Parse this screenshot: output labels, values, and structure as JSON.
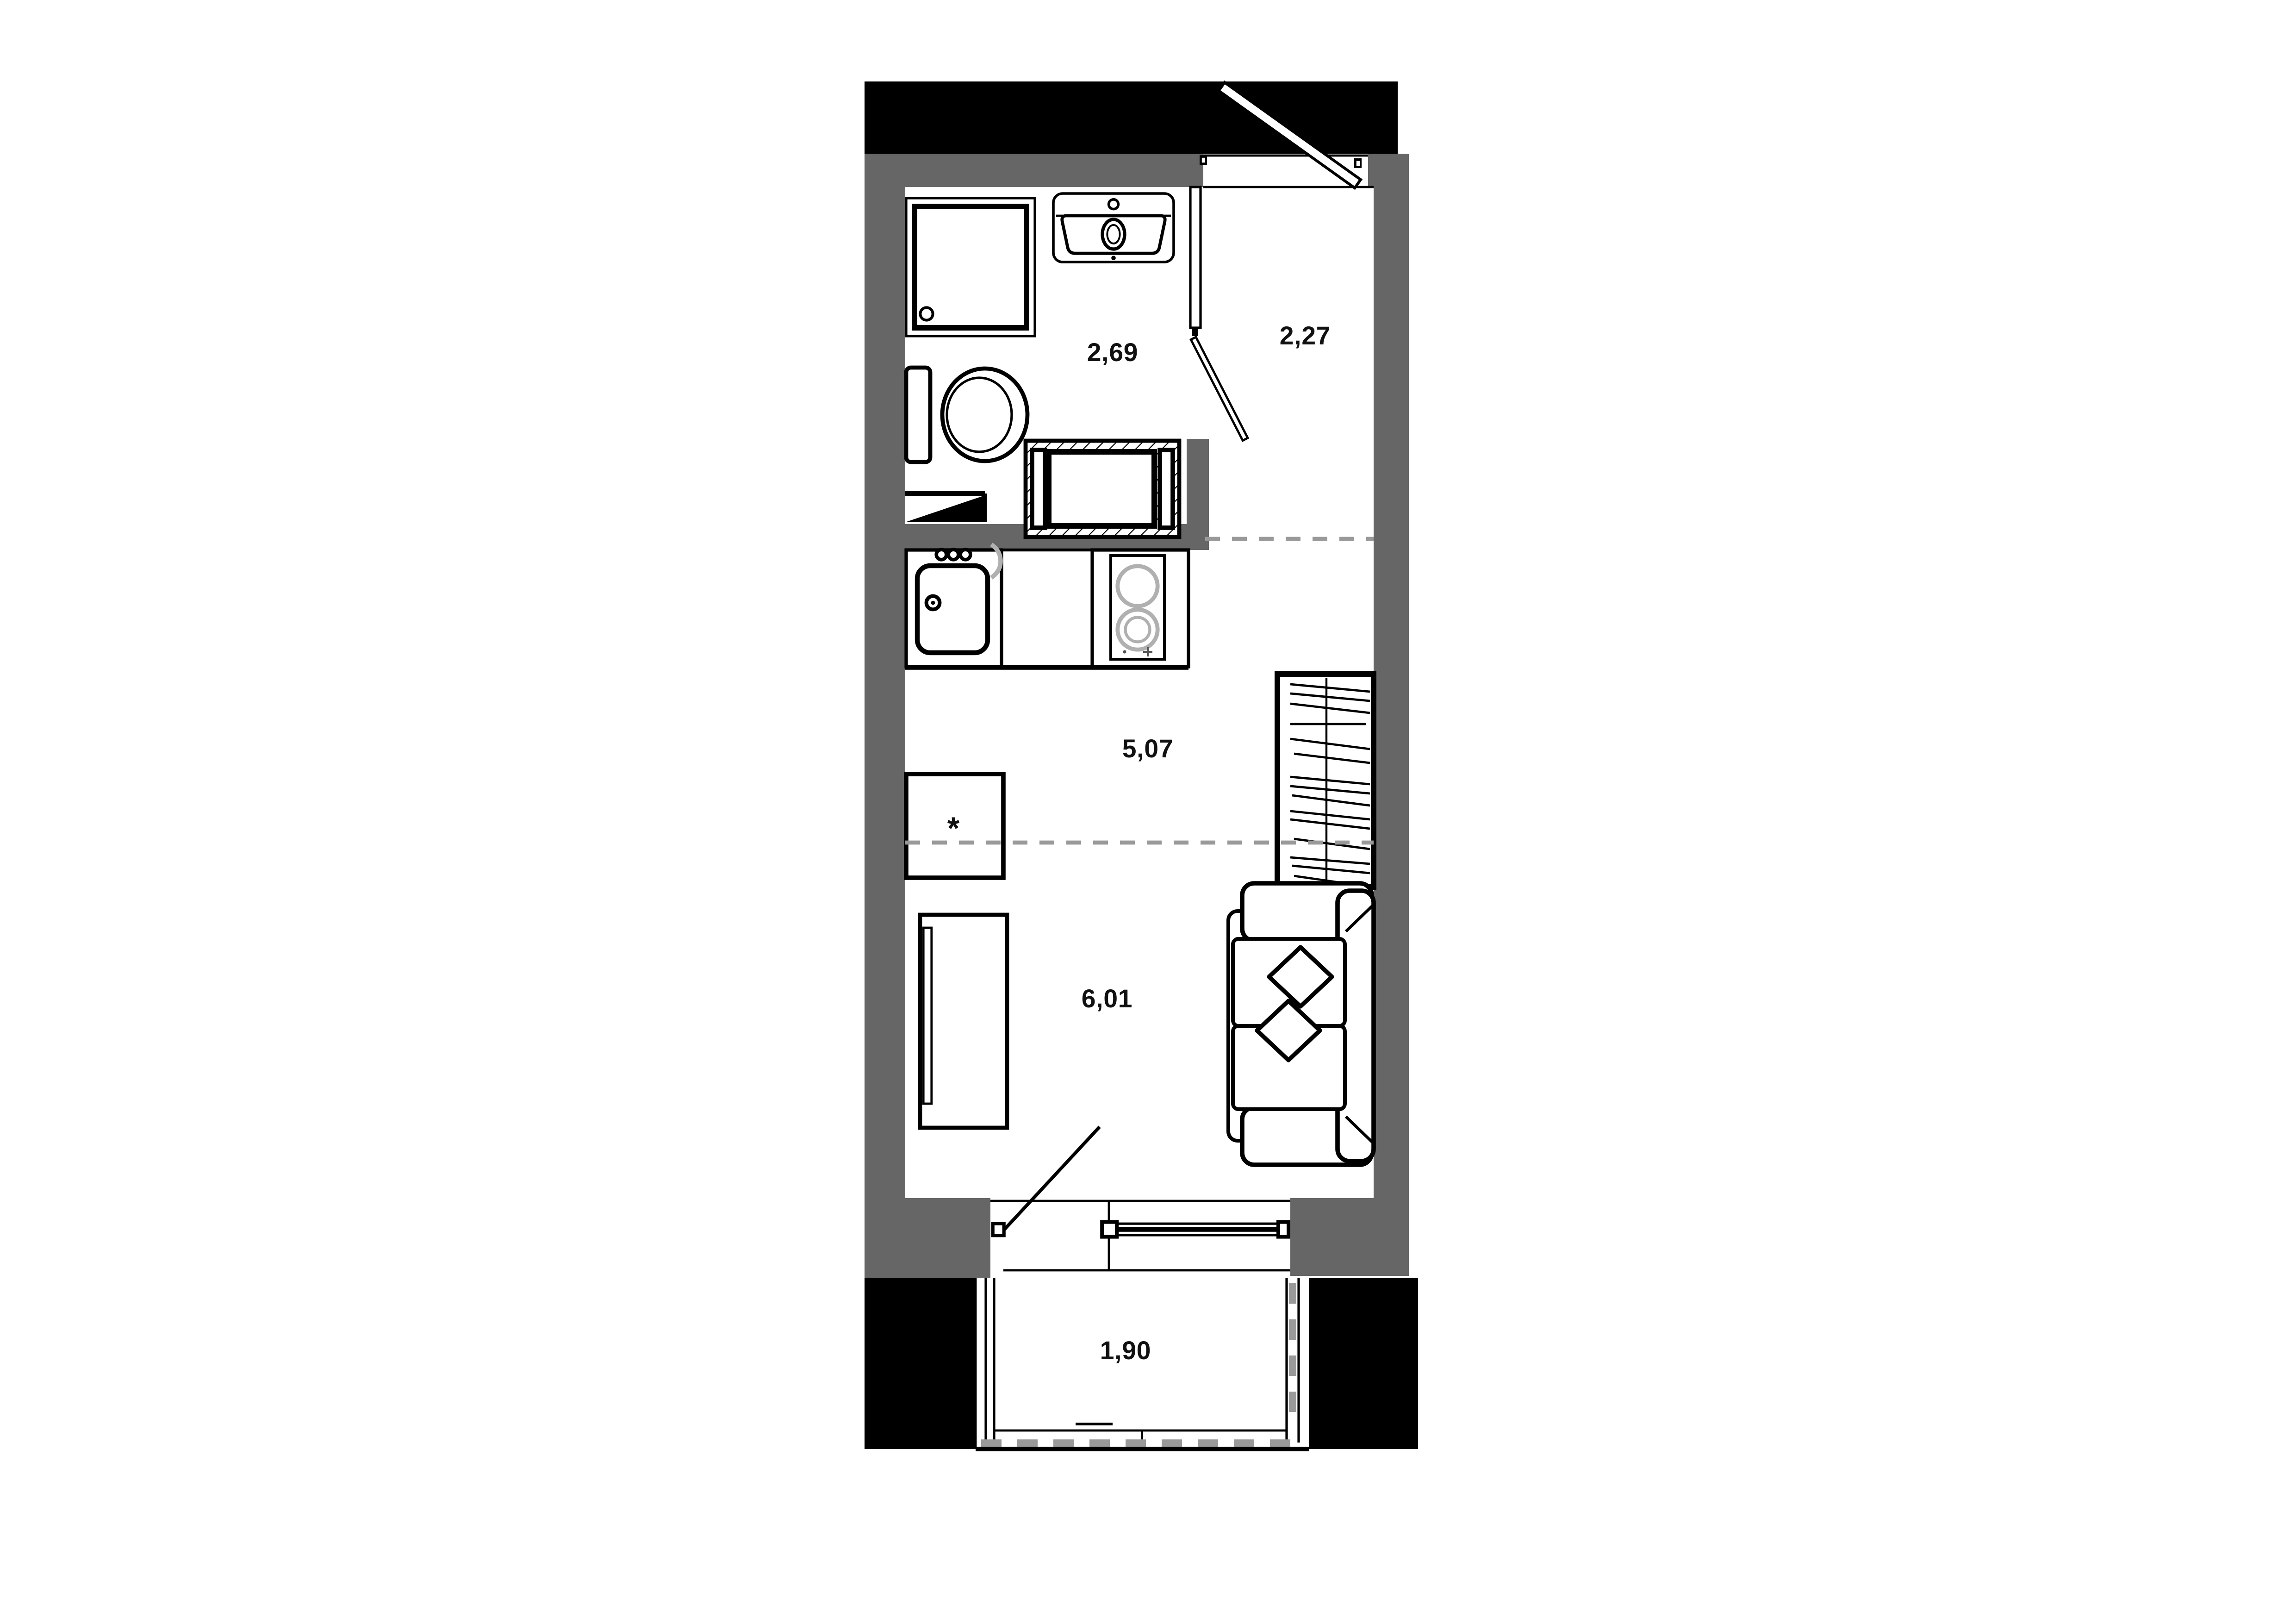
{
  "plan": {
    "type": "apartment-floor-plan",
    "units": "m2",
    "rooms": [
      {
        "id": "bathroom",
        "area_label": "2,69"
      },
      {
        "id": "hallway",
        "area_label": "2,27"
      },
      {
        "id": "kitchen-zone",
        "area_label": "5,07"
      },
      {
        "id": "living-zone",
        "area_label": "6,01"
      },
      {
        "id": "balcony",
        "area_label": "1,90"
      }
    ],
    "annotations": {
      "table_note_symbol": "*"
    },
    "furniture": [
      "shower-cabin",
      "wash-basin",
      "toilet",
      "washing-machine",
      "corner-shelf",
      "kitchen-sink-cabinet",
      "kitchen-counter",
      "stove-two-burners",
      "wardrobe-with-clothes",
      "asterisk-table",
      "desk",
      "sofa-with-pillows"
    ],
    "openings": [
      "entry-door",
      "bathroom-door",
      "balcony-door",
      "window",
      "balcony-glazing"
    ],
    "colors": {
      "walls": "#666666",
      "exterior_mass": "#000000",
      "zone_dashes": "#999999",
      "outline": "#000000",
      "background": "#ffffff",
      "label_text": "#111111"
    }
  }
}
